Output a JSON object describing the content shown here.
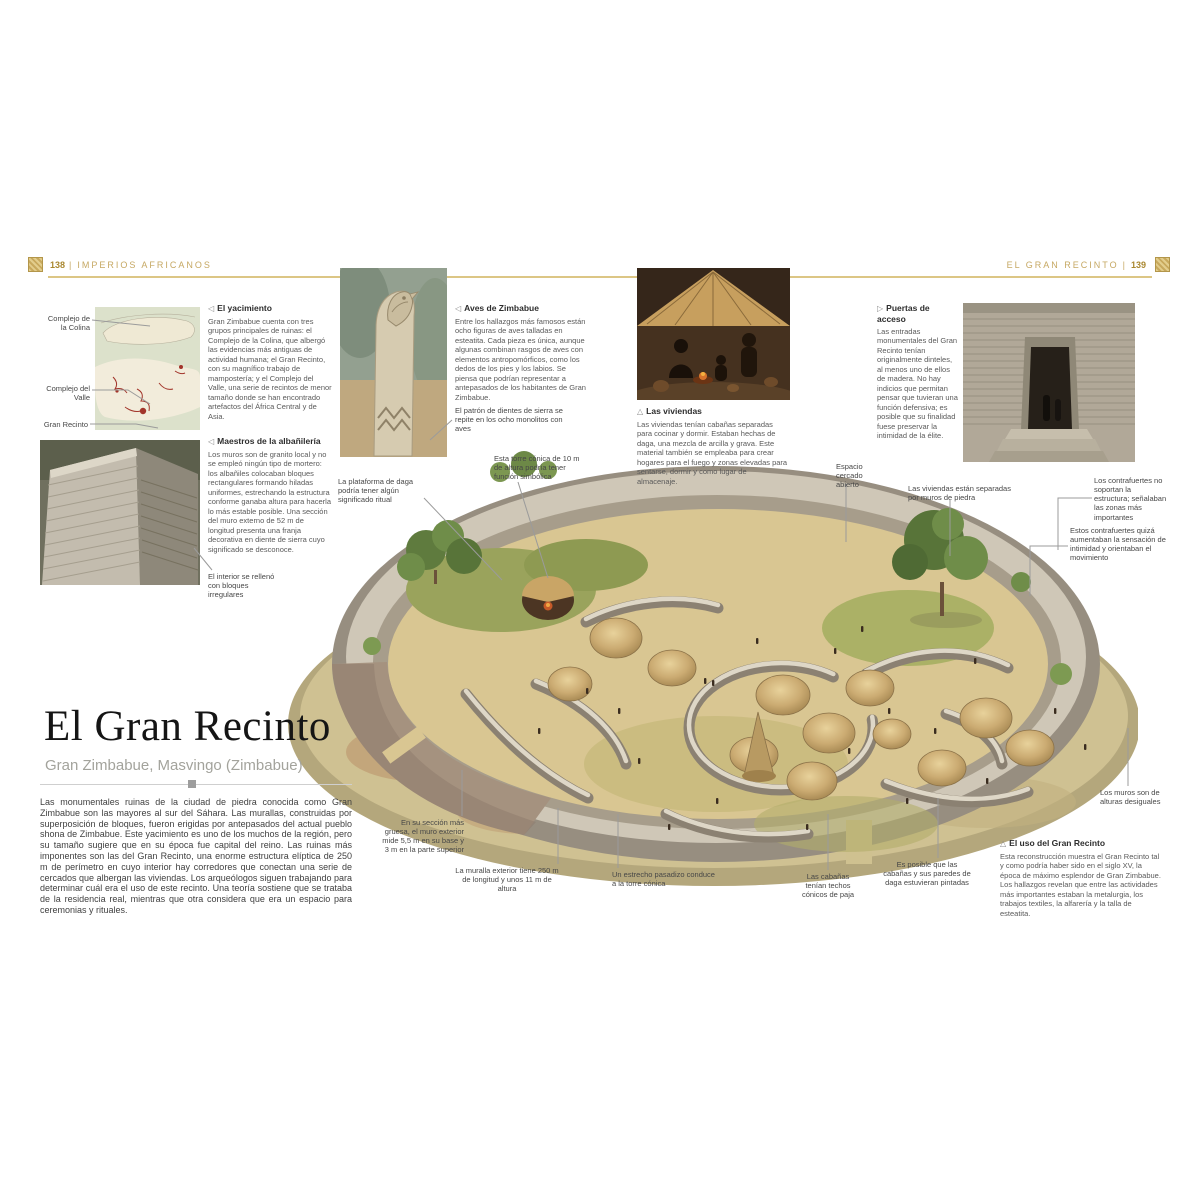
{
  "colors": {
    "accent_gold": "#c8a85c",
    "rule_gold": "#dcc685",
    "heading_dark": "#2d2d2d",
    "body_gray": "#5a5a5a",
    "subtitle_gray": "#a3a39c",
    "map_red": "#a2342a"
  },
  "header": {
    "left_number": "138",
    "left_section": "IMPERIOS AFRICANOS",
    "right_section": "EL GRAN RECINTO",
    "right_number": "139",
    "divider": "|"
  },
  "title_block": {
    "title": "El Gran Recinto",
    "subtitle": "Gran Zimbabue, Masvingo (Zimbabue)",
    "intro": "Las monumentales ruinas de la ciudad de piedra conocida como Gran Zimbabue son las mayores al sur del Sáhara. Las murallas, construidas por superposición de bloques, fueron erigidas por antepasados del actual pueblo shona de Zimbabue. Este yacimiento es uno de los muchos de la región, pero su tamaño sugiere que en su época fue capital del reino. Las ruinas más imponentes son las del Gran Recinto, una enorme estructura elíptica de 250 m de perímetro en cuyo interior hay corredores que conectan una serie de cercados que albergan las viviendas. Los arqueólogos siguen trabajando para determinar cuál era el uso de este recinto. Una teoría sostiene que se trataba de la residencia real, mientras que otra considera que era un espacio para ceremonias y rituales."
  },
  "map": {
    "labels": [
      "Complejo de la Colina",
      "Complejo del Valle",
      "Gran Recinto"
    ]
  },
  "features": {
    "yacimiento": {
      "marker": "◁",
      "heading": "El yacimiento",
      "body": "Gran Zimbabue cuenta con tres grupos principales de ruinas: el Complejo de la Colina, que albergó las evidencias más antiguas de actividad humana; el Gran Recinto, con su magnífico trabajo de mampostería; y el Complejo del Valle, una serie de recintos de menor tamaño donde se han encontrado artefactos del África Central y de Asia."
    },
    "albanileria": {
      "marker": "◁",
      "heading": "Maestros de la albañilería",
      "body": "Los muros son de granito local y no se empleó ningún tipo de mortero: los albañiles colocaban bloques rectangulares formando hiladas uniformes, estrechando la estructura conforme ganaba altura para hacerla lo más estable posible. Una sección del muro externo de 52 m de longitud presenta una franja decorativa en diente de sierra cuyo significado se desconoce."
    },
    "aves": {
      "marker": "◁",
      "heading": "Aves de Zimbabue",
      "body": "Entre los hallazgos más famosos están ocho figuras de aves talladas en esteatita. Cada pieza es única, aunque algunas combinan rasgos de aves con elementos antropomórficos, como los dedos de los pies y los labios. Se piensa que podrían representar a antepasados de los habitantes de Gran Zimbabue."
    },
    "viviendas": {
      "marker": "△",
      "heading": "Las viviendas",
      "body": "Las viviendas tenían cabañas separadas para cocinar y dormir. Estaban hechas de daga, una mezcla de arcilla y grava. Este material también se empleaba para crear hogares para el fuego y zonas elevadas para sentarse, dormir y como lugar de almacenaje."
    },
    "puertas": {
      "marker": "▷",
      "heading": "Puertas de acceso",
      "body": "Las entradas monumentales del Gran Recinto tenían originalmente dinteles, al menos uno de ellos de madera. No hay indicios que permitan pensar que tuvieran una función defensiva; es posible que su finalidad fuese preservar la intimidad de la élite."
    },
    "uso": {
      "marker": "△",
      "heading": "El uso del Gran Recinto",
      "body": "Esta reconstrucción muestra el Gran Recinto tal y como podría haber sido en el siglo XV, la época de máximo esplendor de Gran Zimbabue. Los hallazgos revelan que entre las actividades más importantes estaban la metalurgia, los trabajos textiles, la alfarería y la talla de esteatita."
    }
  },
  "captions": {
    "interior_relleno": "El interior se rellenó con bloques irregulares",
    "patron_sierra": "El patrón de dientes de sierra se repite en los ocho monolitos con aves",
    "torre_conica": "Esta torre cónica de 10 m de altura podría tener función simbólica",
    "plataforma_daga": "La plataforma de daga podría tener algún significado ritual",
    "ganado": "Espacio cercado abierto",
    "viviendas_muros": "Las viviendas están separadas por muros de piedra",
    "contrafuertes_soporte": "Los contrafuertes no soportan la estructura; señalaban las zonas más importantes",
    "contrafuertes_intimidad": "Estos contrafuertes quizá aumentaban la sensación de intimidad y orientaban el movimiento",
    "muros_desiguales": "Los muros son de alturas desiguales",
    "seccion_gruesa": "En su sección más gruesa, el muro exterior mide 5,5 m en su base y 3 m en la parte superior",
    "muralla_exterior": "La muralla exterior tiene 250 m de longitud y unos 11 m de altura",
    "pasadizo": "Un estrecho pasadizo conduce a la torre cónica",
    "cabanas_techos": "Las cabañas tenían techos cónicos de paja",
    "cabanas_pintadas": "Es posible que las cabañas y sus paredes de daga estuvieran pintadas"
  }
}
